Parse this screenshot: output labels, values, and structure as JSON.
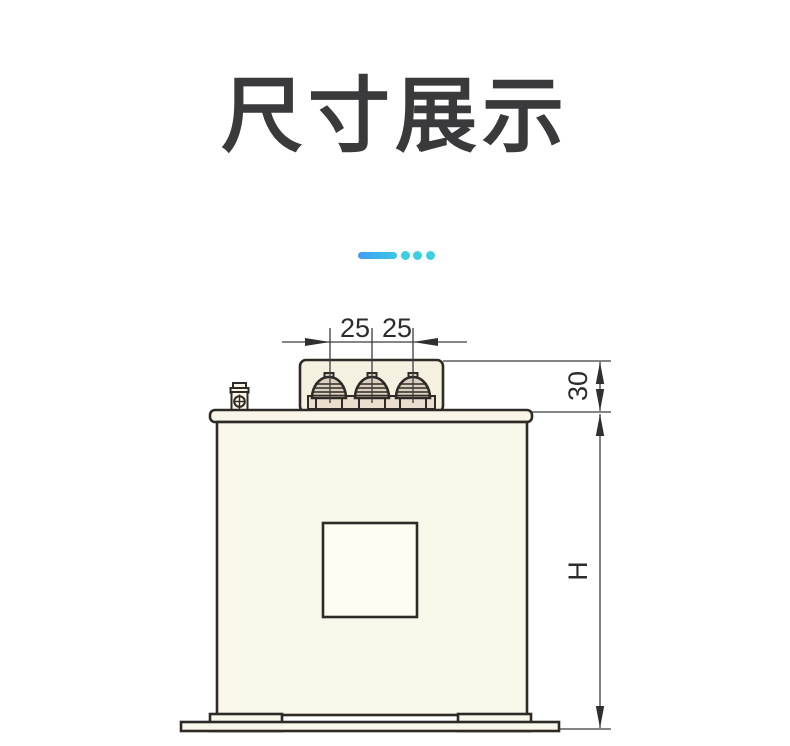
{
  "header": {
    "title": "尺寸展示"
  },
  "divider": {
    "bar_color_start": "#419ef2",
    "bar_color_end": "#3cc6e6",
    "dot_color": "#3bcfdf"
  },
  "drawing": {
    "description": "capacitor-dimension-diagram-front-view",
    "labels": {
      "pitch_left": "25",
      "pitch_right": "25",
      "terminal_height": "30",
      "body_height": "H"
    },
    "colors": {
      "outline": "#2e2a26",
      "body_fill": "#faf8ea",
      "lid_fill": "#f9f6e7",
      "box_fill": "#f5f1e1",
      "terminal_fill": "#eadfcf",
      "dome_fill": "#dbd0bf",
      "window_fill": "#fefdf4",
      "dim_color": "#2c2c2c"
    }
  }
}
